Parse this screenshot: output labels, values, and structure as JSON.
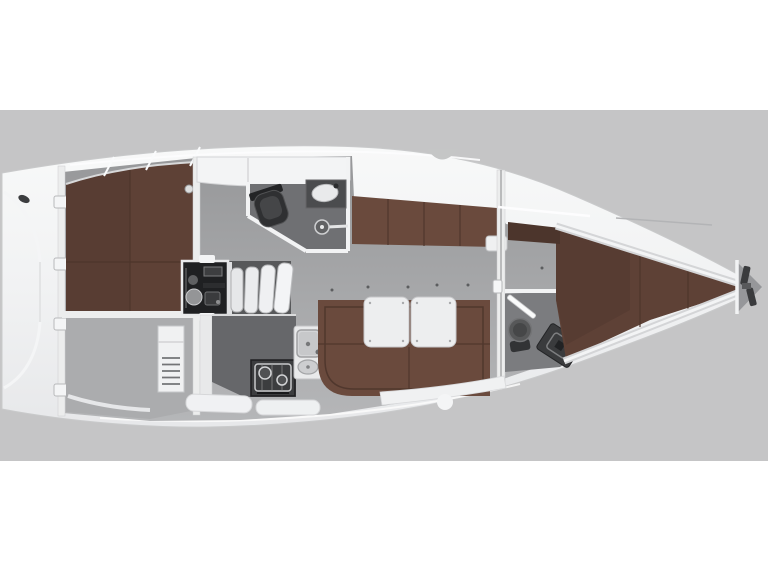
{
  "canvas": {
    "width": 768,
    "height": 576
  },
  "colors": {
    "background": "#ffffff",
    "band": "#c5c5c6",
    "hullEdge": "#c9cacb",
    "wallWhite": "#eceded",
    "lockerWhite": "#f3f4f5",
    "trimWhite": "#f2f3f4",
    "headFloorAft": "#6f7073",
    "headFloorFwd": "#7b7c7f",
    "anchorLockerFloor": "#96979a",
    "berth": "#5e4136",
    "berthShade": "#52392f",
    "berthSeam": "#4d352b",
    "settee": "#6a4a3d",
    "setteeSeam": "#50372d",
    "wardrobe": "#4c352c",
    "table": "#edeeef",
    "tableEdge": "#c6c7c9",
    "engine": "#1f2022",
    "stepWell": "#57585a",
    "step": "#eff0f2",
    "counterDark": "#66676a",
    "stove": "#3c3d3f",
    "sinkWhite": "#e9eaeb",
    "basin": "#d4d5d7",
    "toiletDark": "#2f3032",
    "fixtureGray": "#575859",
    "vanity": "#3a3b3d",
    "windlass": "#3a3b3d",
    "cabinet": "#f0f1f2",
    "storageFloor": "#abacae",
    "dot": "#5c5d5f"
  }
}
